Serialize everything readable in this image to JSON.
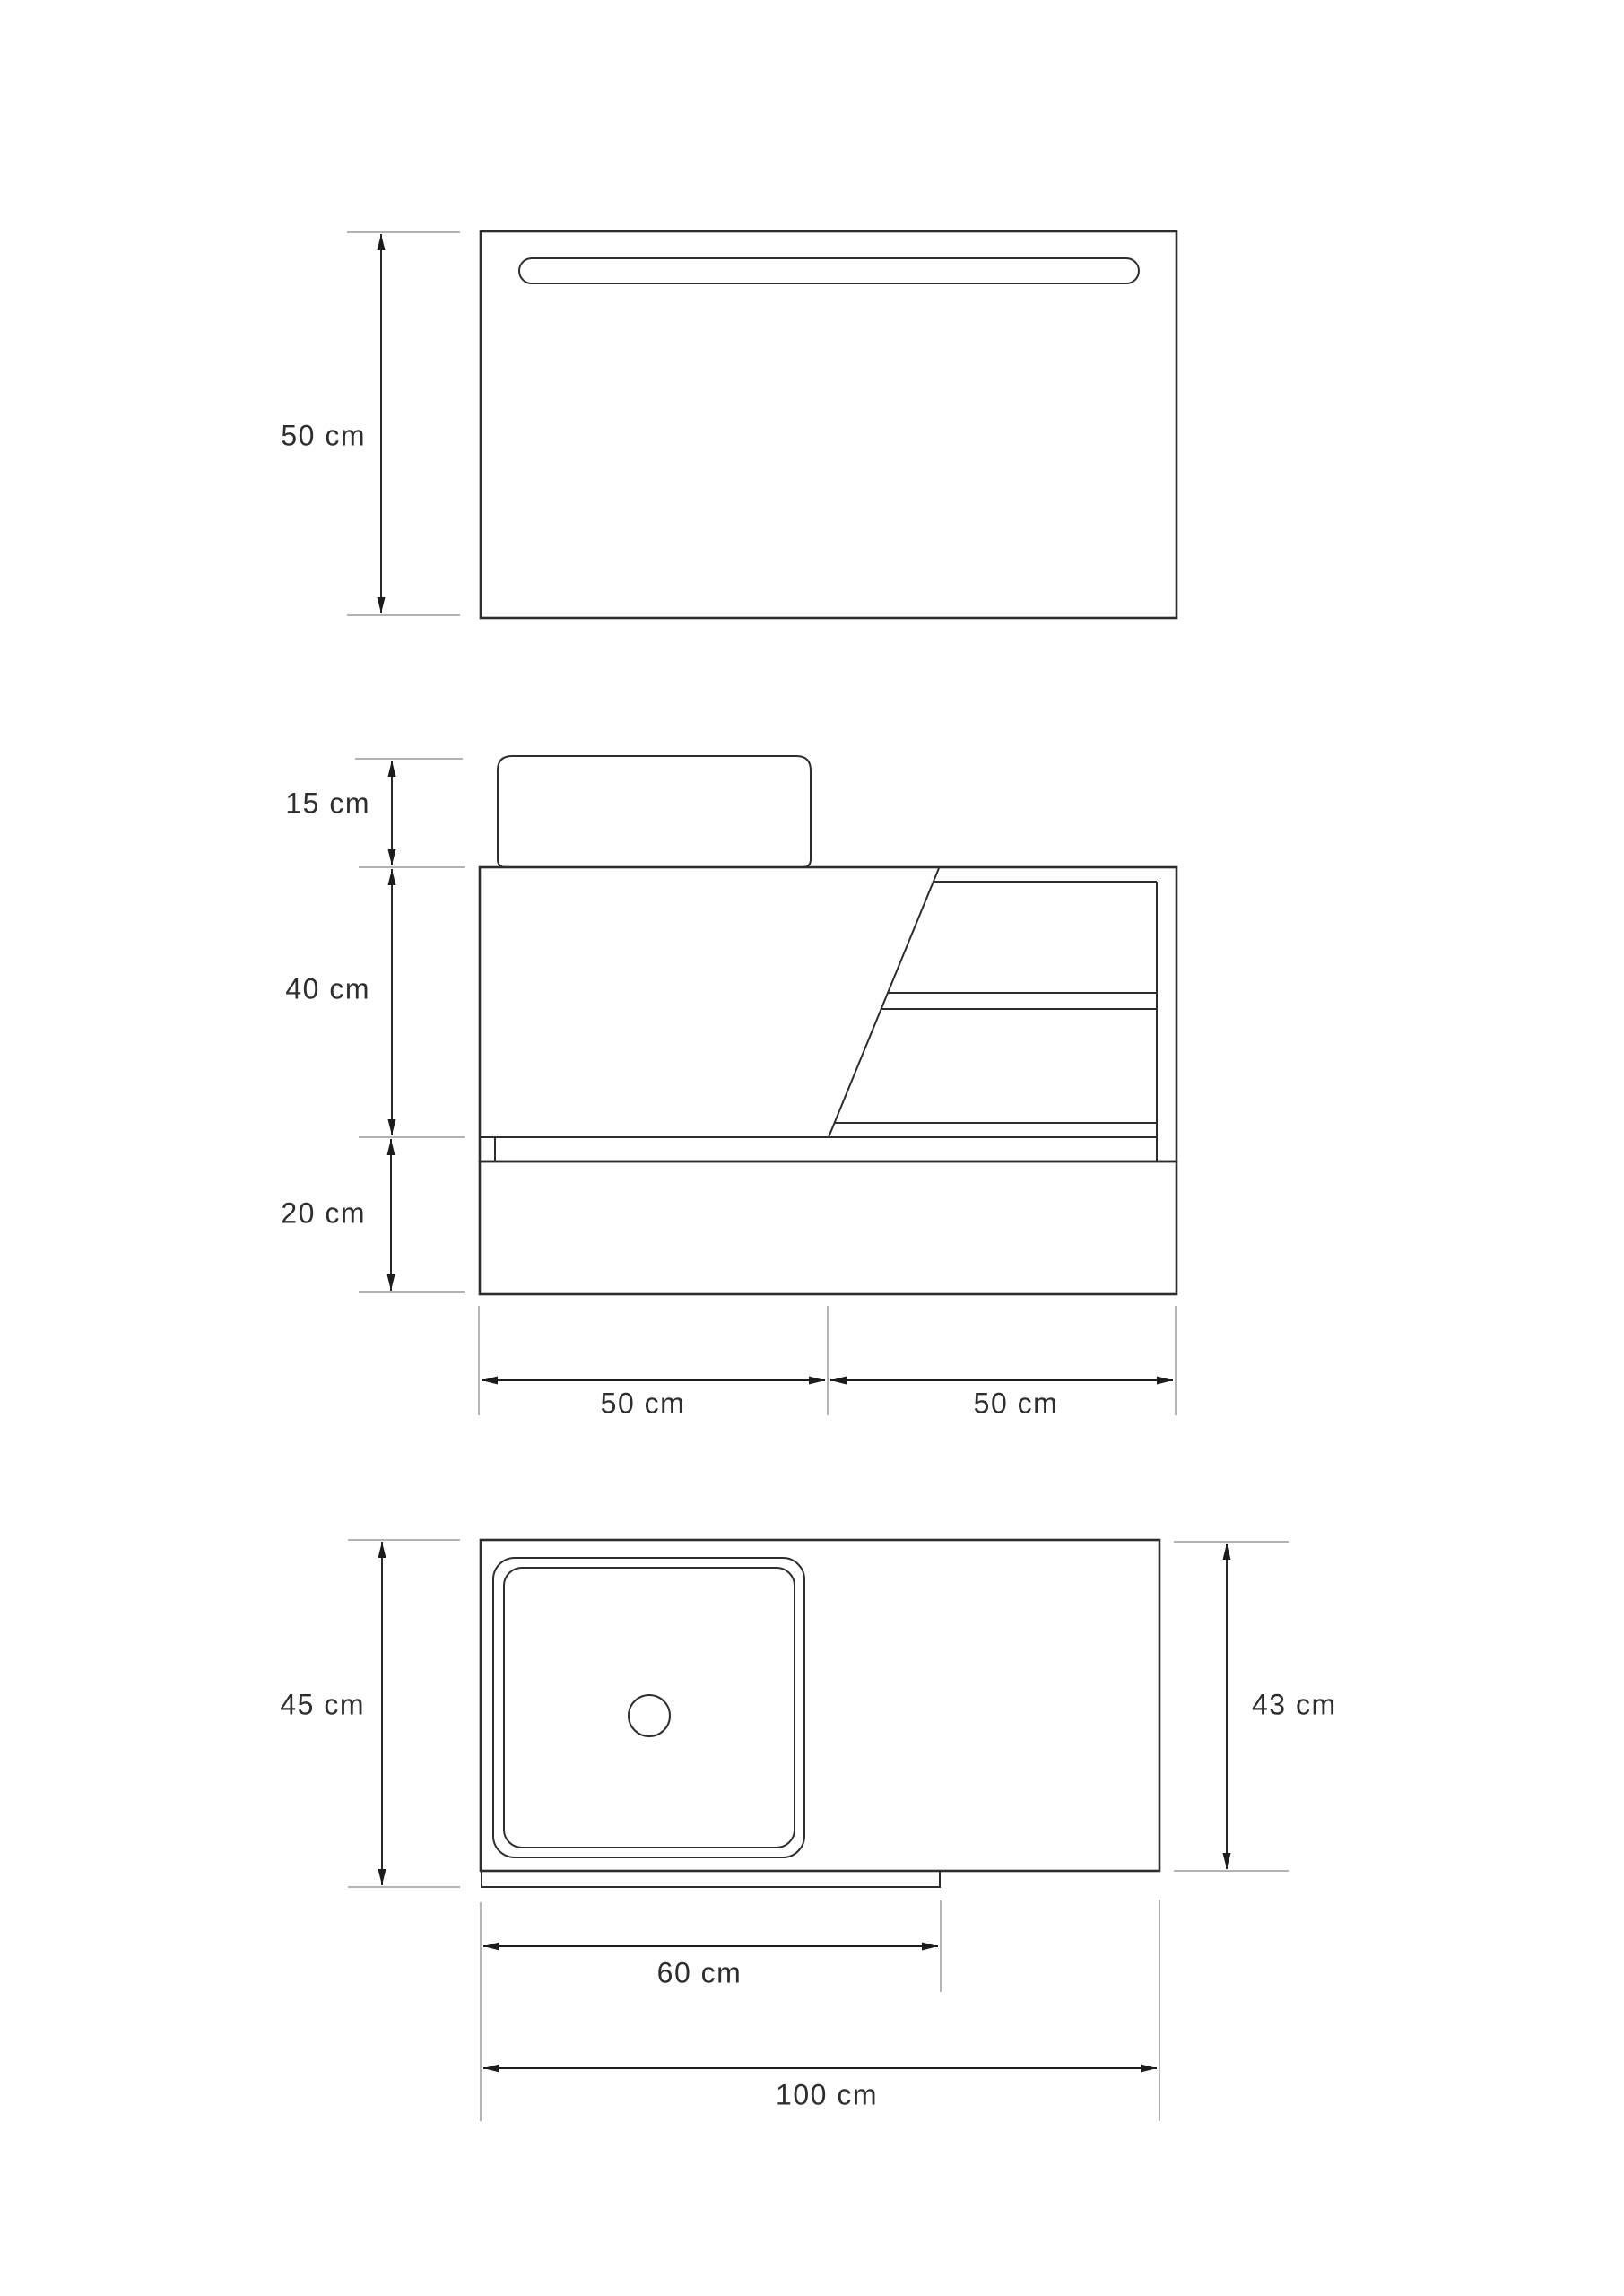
{
  "drawing": {
    "type": "technical-dimension-drawing",
    "background_color": "#ffffff",
    "colors": {
      "object_line": "#2d2d2d",
      "dimension_line": "#1c1c1c",
      "extension_line": "#9a9a9a",
      "label_text": "#2e2e2e"
    },
    "views": {
      "mirror_front": {
        "name": "mirror front view with led strip",
        "dimensions": {
          "height": "50 cm"
        }
      },
      "vanity_front": {
        "name": "vanity cabinet front view with basin, shelves and drawer",
        "dimensions": {
          "basin_height": "15 cm",
          "cabinet_height": "40 cm",
          "drawer_height": "20 cm",
          "left_width": "50 cm",
          "right_width": "50 cm"
        }
      },
      "counter_top": {
        "name": "countertop top view with square sink and drain",
        "dimensions": {
          "total_depth": "45 cm",
          "counter_depth": "43 cm",
          "sink_module_width": "60 cm",
          "total_width": "100 cm"
        }
      }
    }
  }
}
